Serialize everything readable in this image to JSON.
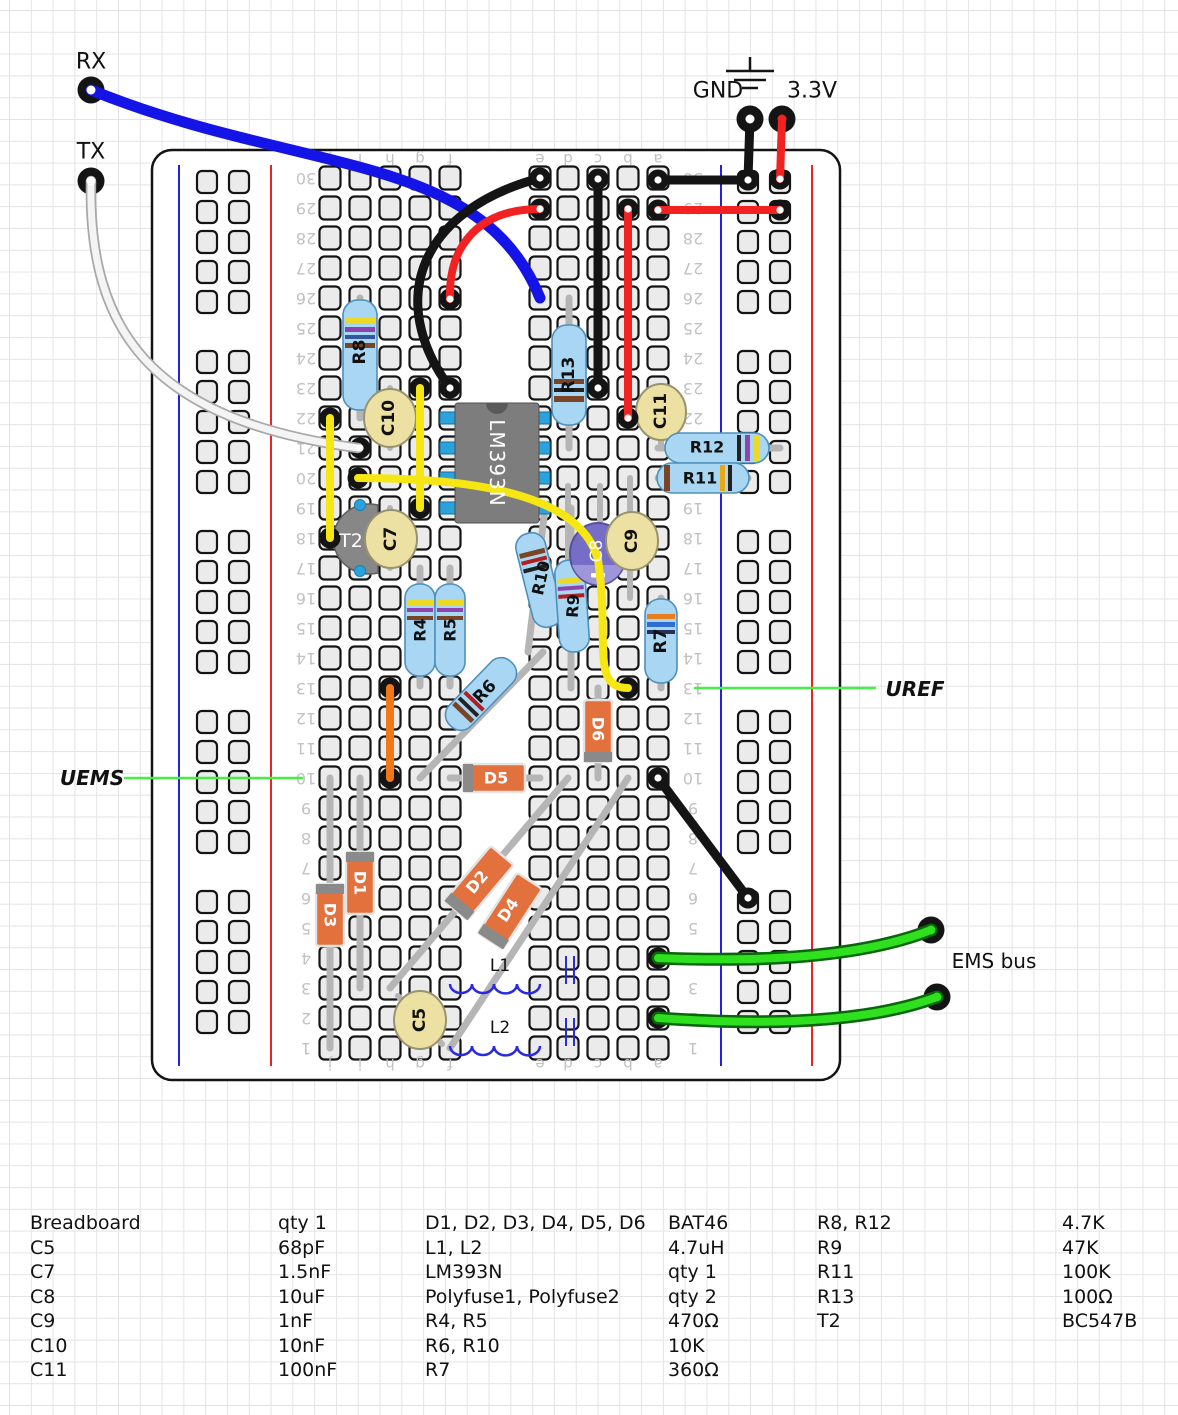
{
  "title": "Breadboard circuit diagram",
  "annotations": {
    "rx": "RX",
    "tx": "TX",
    "gnd": "GND",
    "v33": "3.3V",
    "uref": "UREF",
    "uems": "UEMS",
    "ems_bus": "EMS bus"
  },
  "board": {
    "rows": [
      "1",
      "2",
      "3",
      "4",
      "5",
      "6",
      "7",
      "8",
      "9",
      "10",
      "11",
      "12",
      "13",
      "14",
      "15",
      "16",
      "17",
      "18",
      "19",
      "20",
      "21",
      "22",
      "23",
      "24",
      "25",
      "26",
      "27",
      "28",
      "29",
      "30"
    ],
    "columns_left": [
      "j",
      "i",
      "h",
      "g",
      "f"
    ],
    "columns_right": [
      "e",
      "d",
      "c",
      "b",
      "a"
    ]
  },
  "components": {
    "r4": {
      "label": "R4"
    },
    "r5": {
      "label": "R5"
    },
    "r6": {
      "label": "R6"
    },
    "r7": {
      "label": "R7"
    },
    "r8": {
      "label": "R8"
    },
    "r9": {
      "label": "R9"
    },
    "r10": {
      "label": "R10"
    },
    "r11": {
      "label": "R11"
    },
    "r12": {
      "label": "R12"
    },
    "r13": {
      "label": "R13"
    },
    "c5": {
      "label": "C5"
    },
    "c7": {
      "label": "C7"
    },
    "c8": {
      "label": "C8"
    },
    "c9": {
      "label": "C9"
    },
    "c10": {
      "label": "C10"
    },
    "c11": {
      "label": "C11"
    },
    "d1": {
      "label": "D1"
    },
    "d2": {
      "label": "D2"
    },
    "d3": {
      "label": "D3"
    },
    "d4": {
      "label": "D4"
    },
    "d5": {
      "label": "D5"
    },
    "d6": {
      "label": "D6"
    },
    "l1": {
      "label": "L1"
    },
    "l2": {
      "label": "L2"
    },
    "t2": {
      "label": "T2"
    },
    "ic": {
      "label": "LM393N"
    }
  },
  "parts_list": {
    "groups": [
      {
        "rows": [
          [
            "Breadboard",
            "qty 1"
          ],
          [
            "C5",
            "68pF"
          ],
          [
            "C7",
            "1.5nF"
          ],
          [
            "C8",
            "10uF"
          ],
          [
            "C9",
            "1nF"
          ],
          [
            "C10",
            "10nF"
          ],
          [
            "C11",
            "100nF"
          ]
        ]
      },
      {
        "rows": [
          [
            "D1, D2, D3, D4, D5, D6",
            "BAT46"
          ],
          [
            "L1, L2",
            "4.7uH"
          ],
          [
            "LM393N",
            "qty 1"
          ],
          [
            "Polyfuse1, Polyfuse2",
            "qty 2"
          ],
          [
            "R4, R5",
            "470Ω"
          ],
          [
            "R6, R10",
            "10K"
          ],
          [
            "R7",
            "360Ω"
          ]
        ]
      },
      {
        "rows": [
          [
            "R8, R12",
            "4.7K"
          ],
          [
            "R9",
            "47K"
          ],
          [
            "R11",
            "100K"
          ],
          [
            "R13",
            "100Ω"
          ],
          [
            "T2",
            "BC547B"
          ]
        ]
      }
    ]
  },
  "colors": {
    "wire_blue": "#1414e6",
    "wire_red": "#f32222",
    "wire_black": "#141414",
    "wire_yellow": "#f5e614",
    "wire_white": "#f4f4f4",
    "wire_orange": "#f07818",
    "wire_green": "#2ee01e",
    "annotation_line_green": "#44ee44",
    "rail_blue": "#2222dd",
    "rail_red": "#ee2222",
    "resistor_body": "#a9d7f3",
    "diode_body": "#e2713d",
    "ceramic_cap": "#ece0a2",
    "electrolytic_cap": "#756dc6",
    "ic_body": "#7d7d7d",
    "ic_pin": "#2aa3dc"
  }
}
